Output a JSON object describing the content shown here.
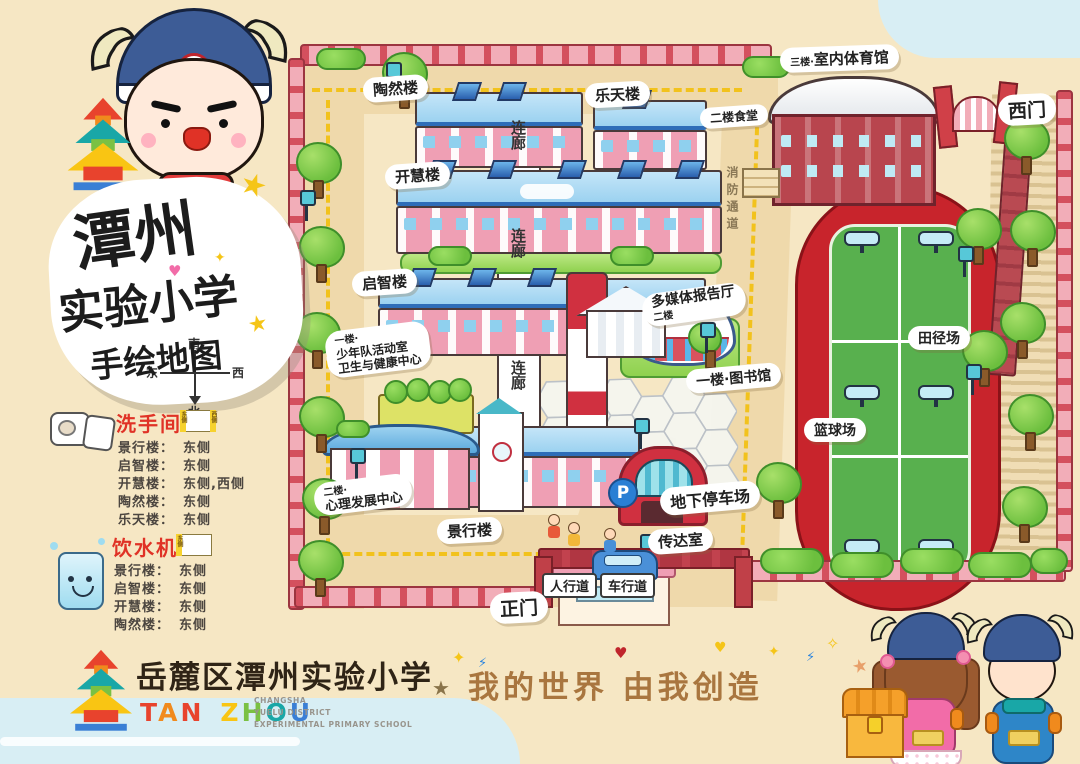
{
  "title": {
    "line1": "潭州",
    "line2": "实验小学",
    "line3": "手绘地图"
  },
  "compass": {
    "south": "南",
    "east": "东",
    "west": "西",
    "north": "北"
  },
  "legend": {
    "restroom": {
      "title": "洗手间",
      "diagram_left": "东侧",
      "diagram_right": "西侧",
      "items": [
        {
          "name": "景行楼：",
          "side": "东侧"
        },
        {
          "name": "启智楼：",
          "side": "东侧"
        },
        {
          "name": "开慧楼：",
          "side": "东侧,西侧"
        },
        {
          "name": "陶然楼：",
          "side": "东侧"
        },
        {
          "name": "乐天楼：",
          "side": "东侧"
        }
      ]
    },
    "water": {
      "title": "饮水机",
      "diagram_left": "东侧",
      "items": [
        {
          "name": "景行楼：",
          "side": "东侧"
        },
        {
          "name": "启智楼：",
          "side": "东侧"
        },
        {
          "name": "开慧楼：",
          "side": "东侧"
        },
        {
          "name": "陶然楼：",
          "side": "东侧"
        }
      ]
    }
  },
  "map": {
    "labels": {
      "taoran": "陶然楼",
      "letian": "乐天楼",
      "kaihui": "开慧楼",
      "qizhi": "启智楼",
      "jingxing": "景行楼",
      "corridor": "连廊",
      "fire_lane": "消防通道",
      "gym_floor": "三楼·",
      "gym": "室内体育馆",
      "canteen": "二楼食堂",
      "multimedia": "多媒体报告厅",
      "multimedia_floor": "二楼",
      "library": "一楼·图书馆",
      "psych_floor": "二楼·",
      "psych": "心理发展中心",
      "youth_floor": "一楼·",
      "youth_line1": "少年队活动室",
      "youth_line2": "卫生与健康中心",
      "reception": "传达室",
      "parking": "地下停车场",
      "parking_badge": "P",
      "track": "田径场",
      "basketball": "篮球场",
      "sidewalk": "人行道",
      "roadway": "车行道",
      "west_gate": "西门",
      "main_gate": "正门"
    }
  },
  "footer": {
    "school_cn": "岳麓区潭州实验小学",
    "pinyin_letters": [
      "T",
      "A",
      "N",
      "Z",
      "H",
      "O",
      "U"
    ],
    "en_line1": "CHANGSHA",
    "en_line2": "YUELU DISTRICT",
    "en_line3": "EXPERIMENTAL PRIMARY SCHOOL",
    "slogan": "我的世界 由我创造"
  },
  "colors": {
    "background": "#f6e7c4",
    "bubble": "#ffffff",
    "legend_red": "#e03226",
    "slogan_brown": "#a9763f",
    "track_red": "#c8242c",
    "court_green": "#58b04e",
    "grass": "#7ccb45",
    "roof_blue": "#a8d8f2",
    "building_pink": "#ef9fb4",
    "fence_pink": "#f2adb8",
    "gym_red": "#b8454e"
  }
}
